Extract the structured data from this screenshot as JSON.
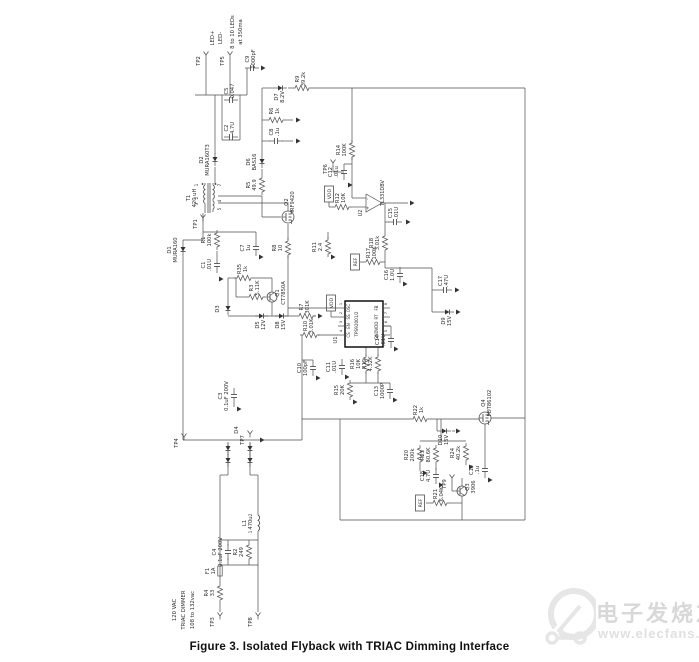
{
  "figure": {
    "caption": "Figure 3.  Isolated Flyback with TRIAC Dimming Interface"
  },
  "watermark": {
    "brand": "电子发烧友",
    "url": "www.elecfans.com",
    "color": "#d8d8d8"
  },
  "colors": {
    "line": "#4d4d4d",
    "label": "#2b2b2b",
    "fill": "#333333"
  },
  "schematic": {
    "input_label_lines": [
      "120 VAC",
      "TRIAC DIMMER",
      "108 to 132vac"
    ],
    "output_label_lines": [
      "LED+",
      "LED-",
      "8 to 10 LEDs",
      "at 350ma"
    ],
    "ic": {
      "ref": "U1",
      "part": "TPS92001/2",
      "left_pins": [
        {
          "n": "1",
          "name": "OSC"
        },
        {
          "n": "2",
          "name": "SS"
        },
        {
          "n": "3",
          "name": "EN"
        },
        {
          "n": "4",
          "name": "CS"
        }
      ],
      "right_pins": [
        {
          "n": "8",
          "name": "FB"
        },
        {
          "n": "7",
          "name": "RT"
        },
        {
          "n": "6",
          "name": "VDD"
        },
        {
          "n": "5",
          "name": "GND"
        }
      ]
    },
    "components": [
      {
        "ref": "LED+",
        "type": "txt",
        "x": 214,
        "y": 38
      },
      {
        "ref": "LED-",
        "type": "txt",
        "x": 222,
        "y": 38
      },
      {
        "ref": "8 to 10 LEDs",
        "type": "txt",
        "x": 234,
        "y": 32
      },
      {
        "ref": "at 350ma",
        "type": "txt",
        "x": 242,
        "y": 32
      },
      {
        "ref": "TP2",
        "type": "tp",
        "x": 206,
        "y": 55
      },
      {
        "ref": "TP5",
        "type": "tp",
        "x": 230,
        "y": 55
      },
      {
        "ref": "C9",
        "val": "1000pF",
        "type": "c",
        "x": 252,
        "y": 68,
        "o": "h"
      },
      {
        "ref": "D7",
        "val": "8.2V",
        "type": "z",
        "x": 281,
        "y": 88,
        "o": "h"
      },
      {
        "ref": "R9",
        "val": "39.2k",
        "type": "r",
        "x": 302,
        "y": 88,
        "o": "h"
      },
      {
        "ref": "R6",
        "val": "1k",
        "type": "r",
        "x": 276,
        "y": 120,
        "o": "h"
      },
      {
        "ref": "C8",
        "val": ".1u",
        "type": "c",
        "x": 276,
        "y": 141,
        "o": "h"
      },
      {
        "ref": "C5",
        "val": "0.047",
        "type": "c",
        "x": 231,
        "y": 100,
        "o": "h"
      },
      {
        "ref": "C2",
        "val": "4.7U",
        "type": "c",
        "x": 231,
        "y": 137,
        "o": "h"
      },
      {
        "ref": "D2",
        "val": "MURA160T3",
        "type": "d",
        "x": 215,
        "y": 160,
        "o": "v"
      },
      {
        "ref": "D6",
        "val": "BAS16",
        "type": "d",
        "x": 262,
        "y": 162,
        "o": "v"
      },
      {
        "ref": "R5",
        "val": "49.9",
        "type": "r",
        "x": 262,
        "y": 185,
        "o": "v"
      },
      {
        "ref": "T1",
        "val": "420 uH",
        "type": "t",
        "x": 209,
        "y": 198
      },
      {
        "ref": "1",
        "type": "pin",
        "x": 198,
        "y": 185
      },
      {
        "ref": "2",
        "type": "pin",
        "x": 198,
        "y": 198
      },
      {
        "ref": "3",
        "type": "pin",
        "x": 198,
        "y": 204
      },
      {
        "ref": "7",
        "type": "pin",
        "x": 221,
        "y": 185
      },
      {
        "ref": "4",
        "type": "pin",
        "x": 221,
        "y": 201
      },
      {
        "ref": "5",
        "type": "pin",
        "x": 221,
        "y": 209
      },
      {
        "ref": "TP1",
        "type": "tp",
        "x": 203,
        "y": 218
      },
      {
        "ref": "Q2",
        "val": "IRF9420",
        "type": "m",
        "x": 288,
        "y": 217
      },
      {
        "ref": "D1",
        "val": "MURA160",
        "type": "d",
        "x": 183,
        "y": 250,
        "o": "v"
      },
      {
        "ref": "R1",
        "val": "100k",
        "type": "r",
        "x": 217,
        "y": 240,
        "o": "v"
      },
      {
        "ref": "C1",
        "val": ".01U",
        "type": "c",
        "x": 217,
        "y": 265,
        "o": "v"
      },
      {
        "ref": "C7",
        "val": "1u",
        "type": "c",
        "x": 256,
        "y": 248,
        "o": "v"
      },
      {
        "ref": "R35",
        "val": "1k",
        "type": "r",
        "x": 244,
        "y": 278,
        "o": "h"
      },
      {
        "ref": "R3",
        "val": "5.11K",
        "type": "r",
        "x": 256,
        "y": 297,
        "o": "h"
      },
      {
        "ref": "Q1",
        "val": "CT7850A",
        "type": "q",
        "x": 272,
        "y": 297
      },
      {
        "ref": "D3",
        "type": "d",
        "x": 228,
        "y": 309,
        "o": "v"
      },
      {
        "ref": "D5",
        "val": "12V",
        "type": "z",
        "x": 262,
        "y": 316,
        "o": "h"
      },
      {
        "ref": "D8",
        "val": "15V",
        "type": "z",
        "x": 282,
        "y": 316,
        "o": "h"
      },
      {
        "ref": "R7",
        "val": "301K",
        "type": "r",
        "x": 306,
        "y": 316,
        "o": "h"
      },
      {
        "ref": "R8",
        "val": "10",
        "type": "r",
        "x": 288,
        "y": 248,
        "o": "v"
      },
      {
        "ref": "C3",
        "val": "0.1uF 200V",
        "type": "c",
        "x": 234,
        "y": 396,
        "o": "v"
      },
      {
        "ref": "VDD",
        "type": "net",
        "x": 329,
        "y": 194
      },
      {
        "ref": "R12",
        "val": "10K",
        "type": "r",
        "x": 342,
        "y": 207,
        "o": "h"
      },
      {
        "ref": "TP6",
        "type": "tp",
        "x": 333,
        "y": 163
      },
      {
        "ref": "R14",
        "val": "100K",
        "type": "r",
        "x": 352,
        "y": 150,
        "o": "v"
      },
      {
        "ref": "C12",
        "val": ".01u",
        "type": "c",
        "x": 344,
        "y": 172,
        "o": "v"
      },
      {
        "ref": "U2",
        "val": "TL331DBV",
        "type": "oa",
        "x": 373,
        "y": 203
      },
      {
        "ref": "R11",
        "val": "2.4",
        "type": "r",
        "x": 328,
        "y": 247,
        "o": "v"
      },
      {
        "ref": "C15",
        "val": ".01U",
        "type": "c",
        "x": 395,
        "y": 222,
        "o": "h"
      },
      {
        "ref": "R18",
        "val": "3.01k",
        "type": "r",
        "x": 385,
        "y": 243,
        "o": "v"
      },
      {
        "ref": "R17",
        "val": "100K",
        "type": "r",
        "x": 373,
        "y": 262,
        "o": "h"
      },
      {
        "ref": "REF",
        "type": "net",
        "x": 355,
        "y": 262
      },
      {
        "ref": "C16",
        "val": "1.0U",
        "type": "c",
        "x": 400,
        "y": 275,
        "o": "v"
      },
      {
        "ref": "C17",
        "val": ".47U",
        "type": "c",
        "x": 445,
        "y": 290,
        "o": "h"
      },
      {
        "ref": "D9",
        "val": "15V",
        "type": "z",
        "x": 448,
        "y": 312,
        "o": "h"
      },
      {
        "ref": "VDD",
        "type": "net",
        "x": 331,
        "y": 303
      },
      {
        "ref": "U1",
        "val": "TPS92001/2",
        "type": "ic",
        "x": 364,
        "y": 324
      },
      {
        "ref": "R10",
        "val": "3.01K",
        "type": "r",
        "x": 310,
        "y": 335,
        "o": "h"
      },
      {
        "ref": "C10",
        "val": "100pF",
        "type": "c",
        "x": 313,
        "y": 368,
        "o": "v"
      },
      {
        "ref": "C11",
        "val": ".01U",
        "type": "c",
        "x": 342,
        "y": 367,
        "o": "v"
      },
      {
        "ref": "R16",
        "val": "10K",
        "type": "r",
        "x": 366,
        "y": 364,
        "o": "v"
      },
      {
        "ref": "R19",
        "val": "4.32K",
        "type": "r",
        "x": 378,
        "y": 364,
        "o": "v"
      },
      {
        "ref": "R15",
        "val": "20K",
        "type": "r",
        "x": 350,
        "y": 390,
        "o": "v"
      },
      {
        "ref": "C13",
        "val": "1000P",
        "type": "c",
        "x": 390,
        "y": 391,
        "o": "v"
      },
      {
        "ref": "C14",
        "val": ".01U",
        "type": "c",
        "x": 391,
        "y": 340,
        "o": "v"
      },
      {
        "ref": "R22",
        "val": "1k",
        "type": "r",
        "x": 420,
        "y": 419,
        "o": "h"
      },
      {
        "ref": "Q4",
        "val": "FDT86102",
        "type": "m",
        "x": 485,
        "y": 418
      },
      {
        "ref": "D10",
        "val": "15V",
        "type": "z",
        "x": 445,
        "y": 431,
        "o": "h"
      },
      {
        "ref": "R20",
        "val": "200k",
        "type": "r",
        "x": 420,
        "y": 455,
        "o": "v"
      },
      {
        "ref": "R23",
        "val": "80.6K",
        "type": "r",
        "x": 436,
        "y": 455,
        "o": "v"
      },
      {
        "ref": "R24",
        "val": "40.2k",
        "type": "r",
        "x": 466,
        "y": 453,
        "o": "v"
      },
      {
        "ref": "C18",
        "val": "4.7U",
        "type": "c",
        "x": 436,
        "y": 476,
        "o": "v"
      },
      {
        "ref": "C19",
        "val": ".1u",
        "type": "c",
        "x": 485,
        "y": 470,
        "o": "v"
      },
      {
        "ref": "TP9",
        "type": "tp",
        "x": 452,
        "y": 478
      },
      {
        "ref": "Q3",
        "val": "3906",
        "type": "q",
        "x": 462,
        "y": 491
      },
      {
        "ref": "REF",
        "type": "net",
        "x": 420,
        "y": 503
      },
      {
        "ref": "R21",
        "val": "6.04K",
        "type": "r",
        "x": 440,
        "y": 503,
        "o": "h"
      },
      {
        "ref": "TP4",
        "type": "tp",
        "x": 184,
        "y": 437
      },
      {
        "ref": "D4",
        "val": "RH04-T",
        "type": "txt",
        "x": 238,
        "y": 430
      },
      {
        "ref": "TP7",
        "type": "tp",
        "x": 250,
        "y": 434
      },
      {
        "type": "d",
        "x": 228,
        "y": 449,
        "o": "v"
      },
      {
        "type": "d",
        "x": 250,
        "y": 449,
        "o": "v"
      },
      {
        "type": "d",
        "x": 228,
        "y": 461,
        "o": "v"
      },
      {
        "type": "d",
        "x": 250,
        "y": 461,
        "o": "v"
      },
      {
        "ref": "L1",
        "val": "470u",
        "type": "l",
        "x": 258,
        "y": 523,
        "o": "v"
      },
      {
        "ref": "1",
        "type": "pin",
        "x": 252,
        "y": 532
      },
      {
        "ref": "2",
        "type": "pin",
        "x": 252,
        "y": 515
      },
      {
        "ref": "C4",
        "val": "0.1uF 200V",
        "type": "c",
        "x": 228,
        "y": 552,
        "o": "v"
      },
      {
        "ref": "R2",
        "val": "249",
        "type": "r",
        "x": 249,
        "y": 552,
        "o": "v"
      },
      {
        "ref": "F1",
        "val": "1A",
        "type": "f",
        "x": 220,
        "y": 571,
        "o": "v"
      },
      {
        "ref": "R4",
        "val": "33",
        "type": "r",
        "x": 220,
        "y": 593,
        "o": "v"
      },
      {
        "ref": "TP3",
        "type": "tp",
        "x": 220,
        "y": 616
      },
      {
        "ref": "TP8",
        "type": "tp",
        "x": 258,
        "y": 616
      },
      {
        "ref": "120 VAC",
        "type": "txt",
        "x": 176,
        "y": 610
      },
      {
        "ref": "TRIAC DIMMER",
        "type": "txt",
        "x": 185,
        "y": 610
      },
      {
        "ref": "108 to 132vac",
        "type": "txt",
        "x": 194,
        "y": 610
      }
    ]
  }
}
